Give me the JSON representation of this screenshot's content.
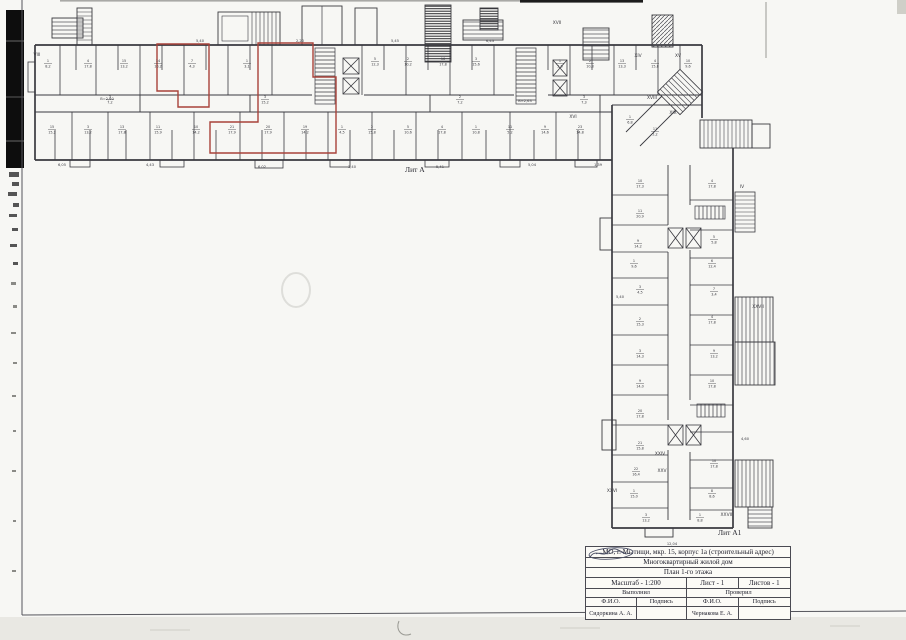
{
  "title_block": {
    "address": "МО, г. Мытищи, мкр. 15, корпус 1а (строительный адрес)",
    "building_type": "Многоквартирный жилой дом",
    "plan_title": "План 1-го этажа",
    "scale": "Масштаб - 1:200",
    "sheet": "Лист - 1",
    "sheets": "Листов - 1",
    "performed": "Выполнил",
    "checked": "Проверил",
    "fio_left": "Ф.И.О.",
    "sign_left": "Подпись",
    "fio_right": "Ф.И.О.",
    "sign_right": "Подпись",
    "performer_name": "Сидоркина А. А.",
    "checker_name": "Чернакова Е. А."
  },
  "plan": {
    "litera_a": "Лит А",
    "litera_a1": "Лит А1",
    "colors": {
      "ink": "#3a3a40",
      "red_outline": "#a8423a",
      "artifact": "#0d0d0d"
    },
    "room_labels": [
      {
        "x": 48,
        "y": 62,
        "n": "1",
        "a": "8,2"
      },
      {
        "x": 88,
        "y": 62,
        "n": "4",
        "a": "17,8"
      },
      {
        "x": 124,
        "y": 62,
        "n": "15",
        "a": "13,2"
      },
      {
        "x": 158,
        "y": 62,
        "n": "14",
        "a": "10,2"
      },
      {
        "x": 192,
        "y": 62,
        "n": "7",
        "a": "4,3"
      },
      {
        "x": 247,
        "y": 62,
        "n": "1",
        "a": "3,1"
      },
      {
        "x": 375,
        "y": 60,
        "n": "5",
        "a": "12,3"
      },
      {
        "x": 408,
        "y": 60,
        "n": "2",
        "a": "10,2"
      },
      {
        "x": 443,
        "y": 60,
        "n": "16",
        "a": "17,8"
      },
      {
        "x": 476,
        "y": 60,
        "n": "3",
        "a": "15,6"
      },
      {
        "x": 560,
        "y": 62,
        "n": "1",
        "a": "5,6"
      },
      {
        "x": 590,
        "y": 62,
        "n": "2",
        "a": "10,8"
      },
      {
        "x": 622,
        "y": 62,
        "n": "13",
        "a": "13,3"
      },
      {
        "x": 655,
        "y": 62,
        "n": "4",
        "a": "15,8"
      },
      {
        "x": 688,
        "y": 62,
        "n": "10",
        "a": "9,6"
      },
      {
        "x": 110,
        "y": 98,
        "n": "3",
        "a": "7,2"
      },
      {
        "x": 265,
        "y": 98,
        "n": "3",
        "a": "15,2"
      },
      {
        "x": 460,
        "y": 98,
        "n": "2",
        "a": "7,2"
      },
      {
        "x": 584,
        "y": 98,
        "n": "3",
        "a": "7,3"
      },
      {
        "x": 52,
        "y": 128,
        "n": "15",
        "a": "15,2"
      },
      {
        "x": 88,
        "y": 128,
        "n": "3",
        "a": "13,2"
      },
      {
        "x": 122,
        "y": 128,
        "n": "13",
        "a": "17,8"
      },
      {
        "x": 158,
        "y": 128,
        "n": "11",
        "a": "15,9"
      },
      {
        "x": 196,
        "y": 128,
        "n": "10",
        "a": "14,2"
      },
      {
        "x": 232,
        "y": 128,
        "n": "21",
        "a": "17,9"
      },
      {
        "x": 268,
        "y": 128,
        "n": "20",
        "a": "17,9"
      },
      {
        "x": 305,
        "y": 128,
        "n": "19",
        "a": "14,2"
      },
      {
        "x": 342,
        "y": 128,
        "n": "1",
        "a": "4,5"
      },
      {
        "x": 372,
        "y": 128,
        "n": "2",
        "a": "15,8"
      },
      {
        "x": 408,
        "y": 128,
        "n": "5",
        "a": "10,6"
      },
      {
        "x": 442,
        "y": 128,
        "n": "4",
        "a": "17,8"
      },
      {
        "x": 476,
        "y": 128,
        "n": "1",
        "a": "10,8"
      },
      {
        "x": 510,
        "y": 128,
        "n": "11",
        "a": "5,2"
      },
      {
        "x": 545,
        "y": 128,
        "n": "9",
        "a": "14,6"
      },
      {
        "x": 580,
        "y": 128,
        "n": "23",
        "a": "14,8"
      },
      {
        "x": 640,
        "y": 182,
        "n": "10",
        "a": "17,3"
      },
      {
        "x": 640,
        "y": 212,
        "n": "11",
        "a": "20,9"
      },
      {
        "x": 638,
        "y": 242,
        "n": "9",
        "a": "14,2"
      },
      {
        "x": 634,
        "y": 262,
        "n": "1",
        "a": "9,6"
      },
      {
        "x": 640,
        "y": 288,
        "n": "3",
        "a": "4,5"
      },
      {
        "x": 640,
        "y": 320,
        "n": "2",
        "a": "15,3"
      },
      {
        "x": 640,
        "y": 352,
        "n": "3",
        "a": "14,3"
      },
      {
        "x": 640,
        "y": 382,
        "n": "9",
        "a": "14,0"
      },
      {
        "x": 640,
        "y": 412,
        "n": "20",
        "a": "17,8"
      },
      {
        "x": 640,
        "y": 444,
        "n": "21",
        "a": "15,8"
      },
      {
        "x": 636,
        "y": 470,
        "n": "22",
        "a": "16,4"
      },
      {
        "x": 634,
        "y": 492,
        "n": "1",
        "a": "15,0"
      },
      {
        "x": 646,
        "y": 516,
        "n": "3",
        "a": "13,2"
      },
      {
        "x": 712,
        "y": 182,
        "n": "4",
        "a": "17,8"
      },
      {
        "x": 714,
        "y": 238,
        "n": "5",
        "a": "5,8"
      },
      {
        "x": 712,
        "y": 262,
        "n": "6",
        "a": "12,4"
      },
      {
        "x": 714,
        "y": 290,
        "n": "7",
        "a": "3,4"
      },
      {
        "x": 712,
        "y": 318,
        "n": "4",
        "a": "17,8"
      },
      {
        "x": 714,
        "y": 352,
        "n": "9",
        "a": "13,2"
      },
      {
        "x": 712,
        "y": 382,
        "n": "10",
        "a": "17,8"
      },
      {
        "x": 714,
        "y": 462,
        "n": "10",
        "a": "17,8"
      },
      {
        "x": 712,
        "y": 492,
        "n": "8",
        "a": "8,6"
      },
      {
        "x": 700,
        "y": 516,
        "n": "1",
        "a": "8,8"
      },
      {
        "x": 630,
        "y": 118,
        "n": "1",
        "a": "6,8"
      },
      {
        "x": 655,
        "y": 130,
        "n": "11",
        "a": "5,2"
      }
    ],
    "roman_labels": [
      {
        "x": 37,
        "y": 56,
        "t": "VIII"
      },
      {
        "x": 557,
        "y": 24,
        "t": "XVII"
      },
      {
        "x": 638,
        "y": 57,
        "t": "XIV"
      },
      {
        "x": 678,
        "y": 57,
        "t": "XV"
      },
      {
        "x": 573,
        "y": 118,
        "t": "XVI"
      },
      {
        "x": 652,
        "y": 99,
        "t": "XVIII"
      },
      {
        "x": 673,
        "y": 114,
        "t": "XIX"
      },
      {
        "x": 742,
        "y": 188,
        "t": "IV"
      },
      {
        "x": 660,
        "y": 455,
        "t": "XXIV"
      },
      {
        "x": 662,
        "y": 472,
        "t": "XXV"
      },
      {
        "x": 612,
        "y": 492,
        "t": "XXVI"
      },
      {
        "x": 758,
        "y": 308,
        "t": "XXVII"
      },
      {
        "x": 727,
        "y": 516,
        "t": "XXVIII"
      }
    ],
    "dim_labels": [
      {
        "x": 62,
        "y": 166,
        "t": "6,05"
      },
      {
        "x": 150,
        "y": 166,
        "t": "4,43"
      },
      {
        "x": 262,
        "y": 168,
        "t": "6,02"
      },
      {
        "x": 352,
        "y": 168,
        "t": "3,40"
      },
      {
        "x": 440,
        "y": 168,
        "t": "5,41"
      },
      {
        "x": 532,
        "y": 166,
        "t": "5,04"
      },
      {
        "x": 598,
        "y": 166,
        "t": "1,39"
      },
      {
        "x": 672,
        "y": 545,
        "t": "12,04"
      },
      {
        "x": 620,
        "y": 298,
        "t": "5,40"
      },
      {
        "x": 745,
        "y": 440,
        "t": "4,60"
      },
      {
        "x": 200,
        "y": 42,
        "t": "5,40"
      },
      {
        "x": 300,
        "y": 42,
        "t": "2,20"
      },
      {
        "x": 395,
        "y": 42,
        "t": "5,45"
      },
      {
        "x": 490,
        "y": 42,
        "t": "6,43"
      },
      {
        "x": 107,
        "y": 100,
        "t": "В=2,60"
      },
      {
        "x": 525,
        "y": 102,
        "t": "В=2,63"
      }
    ]
  }
}
